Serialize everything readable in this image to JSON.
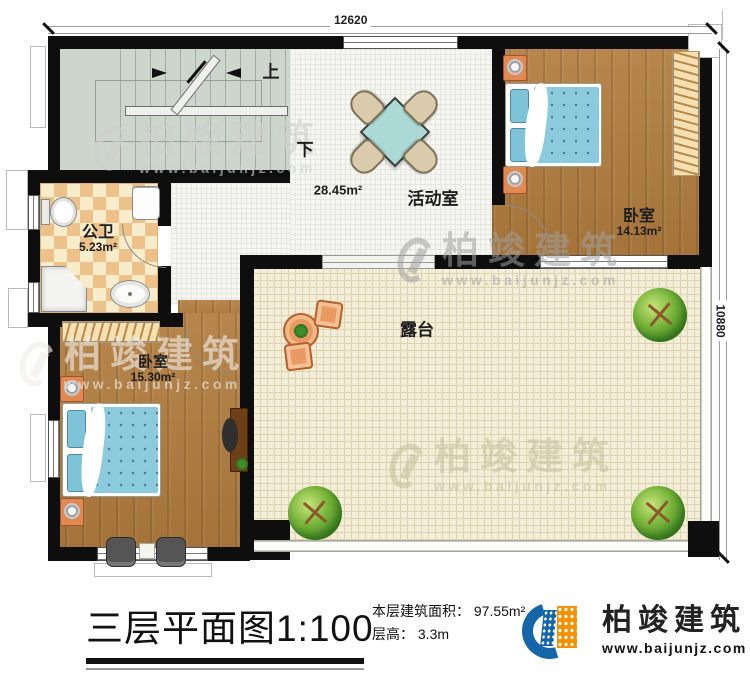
{
  "dimensions": {
    "top": "12620",
    "right": "10880"
  },
  "stairs": {
    "up_label": "上",
    "down_label": "下"
  },
  "rooms": {
    "activity": {
      "name": "活动室",
      "area": "28.45m²"
    },
    "bathroom": {
      "name": "公卫",
      "area": "5.23m²"
    },
    "bedroom_top": {
      "name": "卧室",
      "area": "14.13m²"
    },
    "bedroom_bottom": {
      "name": "卧室",
      "area": "15.30m²"
    },
    "terrace": {
      "name": "露台"
    }
  },
  "footer": {
    "title": "三层平面图",
    "scale": "1:100",
    "area_label": "本层建筑面积：",
    "area_value": "97.55m²",
    "floor_height_label": "层高：",
    "floor_height_value": "3.3m"
  },
  "logo": {
    "name": "柏竣建筑",
    "url": "www.baijunjz.com"
  },
  "watermark": {
    "brand": "柏竣建筑",
    "url": "www.baijunjz.com"
  },
  "colors": {
    "wall": "#0e0e0e",
    "logo_blue": "#1566a9",
    "logo_orange": "#f39204",
    "wood": "#b07c3e",
    "terrace": "#f3eeda"
  }
}
